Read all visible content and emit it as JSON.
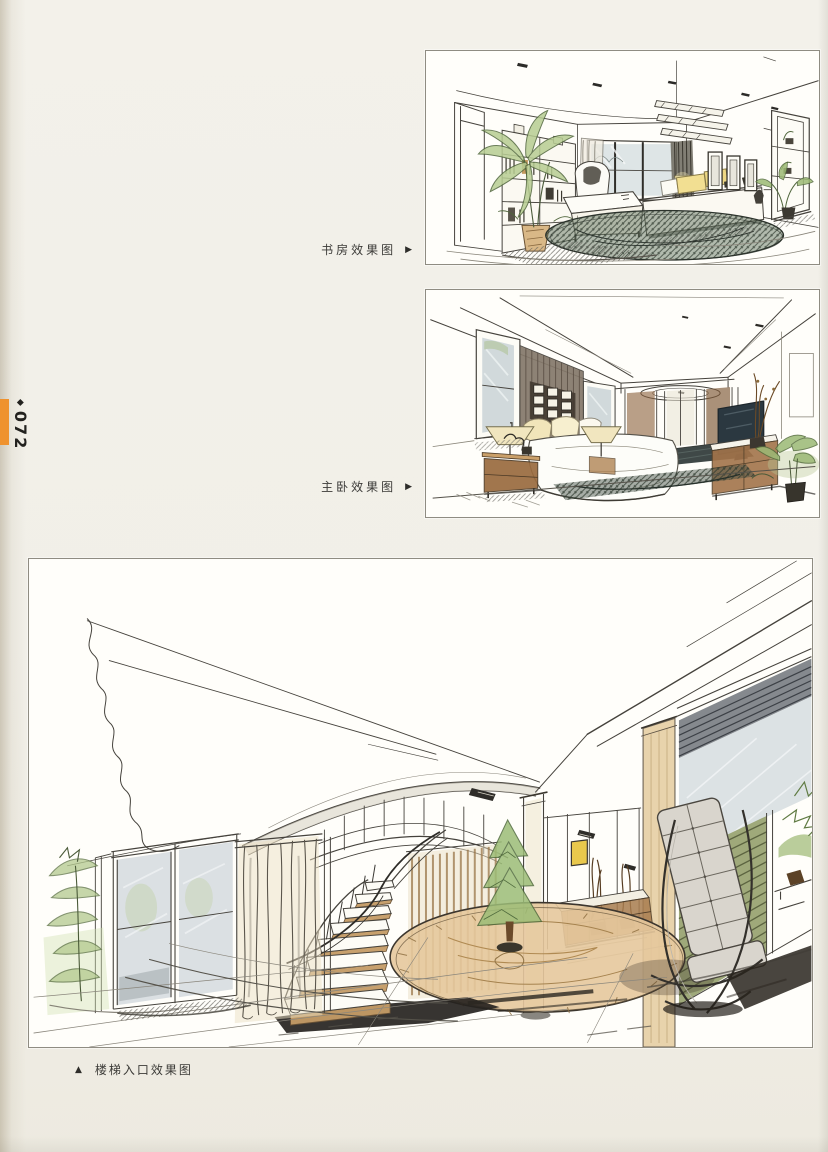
{
  "page": {
    "number": "072",
    "marker_glyph": "◆",
    "accent_color": "#ef922e",
    "paper_color": "#f1efe8",
    "panel_border_color": "#8f8c82"
  },
  "figures": [
    {
      "name": "study",
      "caption": "书房效果图",
      "marker": "▶"
    },
    {
      "name": "master-bedroom",
      "caption": "主卧效果图",
      "marker": "▶"
    },
    {
      "name": "stair-entrance",
      "caption": "楼梯入口效果图",
      "marker": "▲"
    }
  ],
  "sketch_palette": {
    "ink": "#45423c",
    "plant_green": "#9cbd77",
    "wash_tan": "#e5c89c",
    "wash_yellow": "#f1dd8f",
    "wood_brown": "#9a6b3f",
    "glass_blue_gray": "#ccd3d8",
    "tv_slate": "#2b3840",
    "shutter_olive": "#95a06b"
  }
}
